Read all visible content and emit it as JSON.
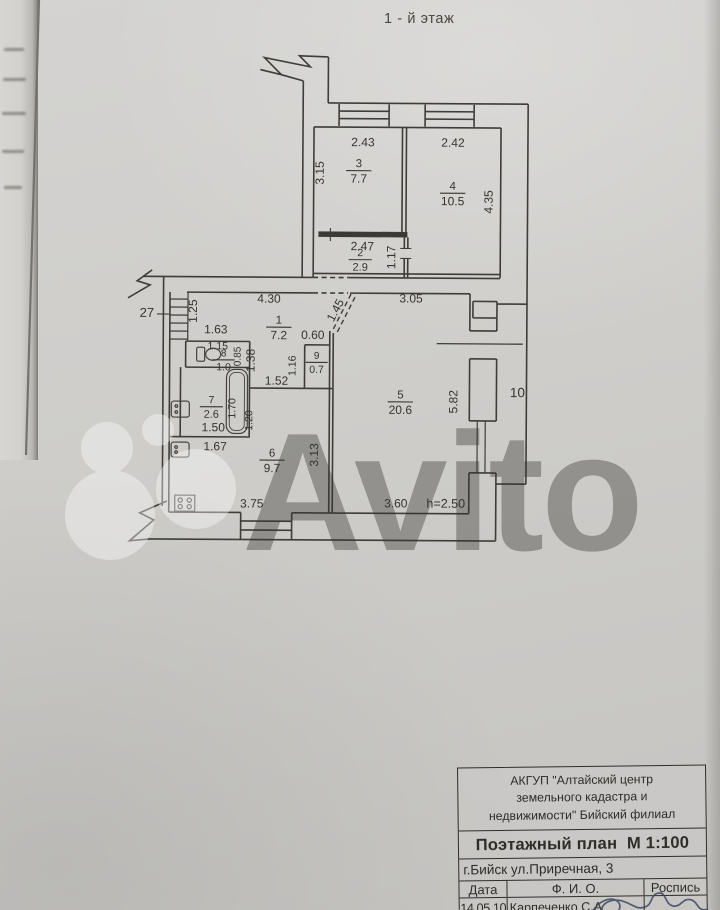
{
  "page": {
    "title": "1 - й этаж"
  },
  "watermark": {
    "text": "Avito"
  },
  "plan": {
    "rooms": [
      {
        "n": "3",
        "a": "7.7",
        "x": 358,
        "y": 167,
        "s": 12
      },
      {
        "n": "4",
        "a": "10.5",
        "x": 452,
        "y": 189,
        "s": 12
      },
      {
        "n": "2",
        "a": "2.9",
        "x": 360,
        "y": 256,
        "s": 11
      },
      {
        "n": "1",
        "a": "7.2",
        "x": 279,
        "y": 324,
        "s": 12
      },
      {
        "n": "8",
        "a": "1.0",
        "x": 224,
        "y": 357,
        "s": 10.5
      },
      {
        "n": "9",
        "a": "0.7",
        "x": 317,
        "y": 359,
        "s": 10.5
      },
      {
        "n": "7",
        "a": "2.6",
        "x": 212,
        "y": 404,
        "s": 11
      },
      {
        "n": "6",
        "a": "9.7",
        "x": 273,
        "y": 457,
        "s": 12
      },
      {
        "n": "5",
        "a": "20.6",
        "x": 401,
        "y": 398,
        "s": 12
      }
    ],
    "dims": [
      {
        "t": "2.43",
        "x": 362,
        "y": 146
      },
      {
        "t": "2.42",
        "x": 452,
        "y": 146
      },
      {
        "t": "3.15",
        "x": 323,
        "y": 173,
        "r": -90
      },
      {
        "t": "4.35",
        "x": 492,
        "y": 201,
        "r": -90
      },
      {
        "t": "2.47",
        "x": 362,
        "y": 250
      },
      {
        "t": "1.17",
        "x": 395,
        "y": 257,
        "r": -90
      },
      {
        "t": "4.30",
        "x": 269,
        "y": 303
      },
      {
        "t": "3.05",
        "x": 411,
        "y": 302
      },
      {
        "t": "1.45",
        "x": 339,
        "y": 312,
        "r": -62
      },
      {
        "t": "1.25",
        "x": 197,
        "y": 312,
        "r": -90
      },
      {
        "t": "27",
        "x": 147,
        "y": 318,
        "s": 13
      },
      {
        "t": "1.63",
        "x": 216,
        "y": 334
      },
      {
        "t": "0.60",
        "x": 313,
        "y": 339
      },
      {
        "t": "1.15",
        "x": 218,
        "y": 350,
        "s": 10.5
      },
      {
        "t": "0.85",
        "x": 241,
        "y": 357,
        "r": -90,
        "s": 10
      },
      {
        "t": "1.38",
        "x": 255,
        "y": 361,
        "r": -90
      },
      {
        "t": "1.16",
        "x": 296,
        "y": 366,
        "r": -90,
        "s": 10.5
      },
      {
        "t": "1.52",
        "x": 277,
        "y": 385
      },
      {
        "t": "1.70",
        "x": 236,
        "y": 409,
        "r": -90,
        "s": 10.5
      },
      {
        "t": "1.20",
        "x": 253,
        "y": 421,
        "r": -90,
        "s": 10.5
      },
      {
        "t": "1.50",
        "x": 214,
        "y": 432
      },
      {
        "t": "1.67",
        "x": 216,
        "y": 451
      },
      {
        "t": "3.13",
        "x": 319,
        "y": 455,
        "r": -90
      },
      {
        "t": "5.82",
        "x": 458,
        "y": 401,
        "r": -90
      },
      {
        "t": "10",
        "x": 518,
        "y": 396,
        "s": 13.5
      },
      {
        "t": "3.75",
        "x": 253,
        "y": 508
      },
      {
        "t": "3.60",
        "x": 397,
        "y": 507
      },
      {
        "t": "h=2.50",
        "x": 447,
        "y": 507,
        "s": 12.5
      }
    ],
    "icons": [
      "staircase-icon",
      "toilet-icon",
      "bathtub-icon",
      "bath-sink-icon",
      "kitchen-sink-icon",
      "stove-icon",
      "window-icon"
    ]
  },
  "stamp": {
    "org_line1": "АКГУП \"Алтайский центр",
    "org_line2": "земельного кадастра и",
    "org_line3": "недвижимости\" Бийский филиал",
    "doc_title": "Поэтажный план  М 1:100",
    "address": "г.Бийск ул.Приречная, 3",
    "col_date": "Дата",
    "col_name": "Ф. И. О.",
    "col_sign": "Роспись",
    "date_value": "14.05.10",
    "name_value": "Карпеченко С.А"
  }
}
